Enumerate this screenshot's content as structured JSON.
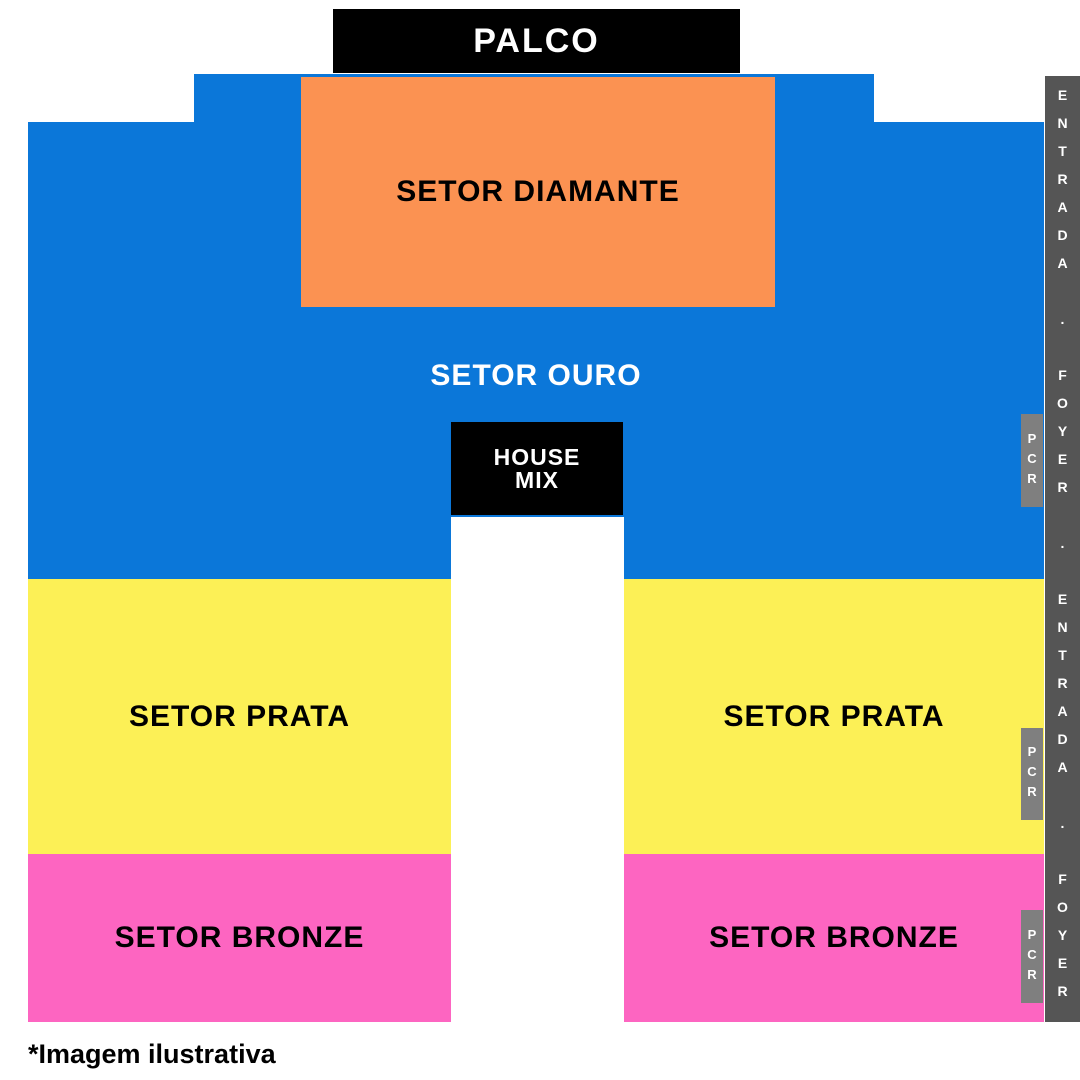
{
  "stage": {
    "label": "PALCO"
  },
  "sectors": {
    "diamante": {
      "label": "SETOR DIAMANTE"
    },
    "ouro": {
      "label": "SETOR OURO"
    },
    "house_mix": {
      "label": "HOUSE\nMIX"
    },
    "prata_left": {
      "label": "SETOR PRATA"
    },
    "prata_right": {
      "label": "SETOR PRATA"
    },
    "bronze_left": {
      "label": "SETOR BRONZE"
    },
    "bronze_right": {
      "label": "SETOR BRONZE"
    }
  },
  "entrance_strip": {
    "text": "ENTRADA . FOYER . ENTRADA . FOYER"
  },
  "pcr_boxes": [
    {
      "label": "PCR"
    },
    {
      "label": "PCR"
    },
    {
      "label": "PCR"
    }
  ],
  "footer": {
    "note": "*Imagem ilustrativa"
  },
  "colors": {
    "stage": "#000000",
    "diamante": "#fb9252",
    "ouro": "#0b77d9",
    "prata": "#fcf056",
    "bronze": "#fd65c1",
    "entrance_strip": "#555555",
    "pcr": "#7f7f7f",
    "house_mix": "#000000"
  }
}
